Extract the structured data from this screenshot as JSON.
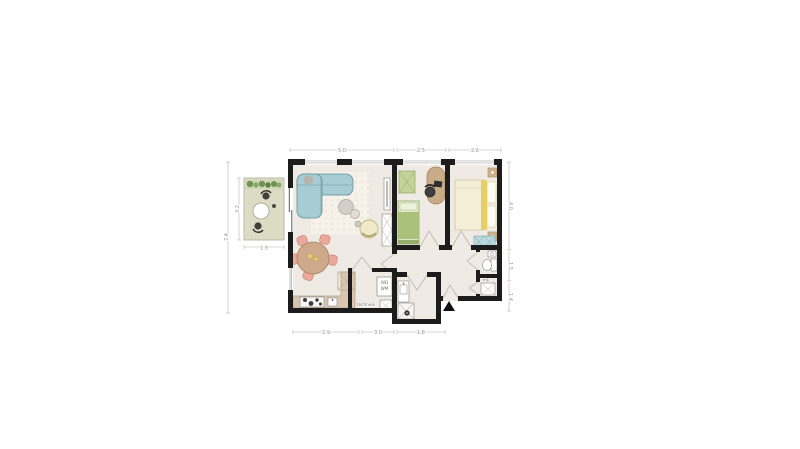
{
  "floor_plan": {
    "labels": {
      "washer_dryer_line1": "WD",
      "washer_dryer_line2": "WM",
      "techniek": "techniek",
      "meter_closet": "mk"
    },
    "dimensions": {
      "top": [
        "5.0",
        "2.5",
        "2.6"
      ],
      "bottom": [
        "2.9",
        "3.0",
        "1.8"
      ],
      "right": [
        "4.0",
        "1.5",
        "1.4"
      ],
      "left_total": "7.4",
      "terrace_height": "3.2",
      "terrace_width": "1.9"
    },
    "colors": {
      "wall": "#1c1c1c",
      "floor": "#efeae3",
      "terrace_floor": "#dcdcc5",
      "plant_bed": "#cfd6b4",
      "plants": "#6f9154",
      "sofa": "#a6cdd3",
      "rug": "#f6f2ea",
      "dining_table": "#cfa98b",
      "dining_chair": "#eba99c",
      "kitchen_counter": "#d9c6af",
      "bed_single": "#a9c17b",
      "bed_single_light": "#dfe8c8",
      "wardrobe_green": "#c3d39a",
      "bed_double": "#f4eed6",
      "bed_double_accent": "#e7cf63",
      "nightstand": "#cfb58f",
      "wardrobe_teal": "#b9d9dd",
      "desk": "#c9ab88",
      "armchair": "#f0e8c6",
      "coffee_table": "#d4cec8"
    }
  }
}
